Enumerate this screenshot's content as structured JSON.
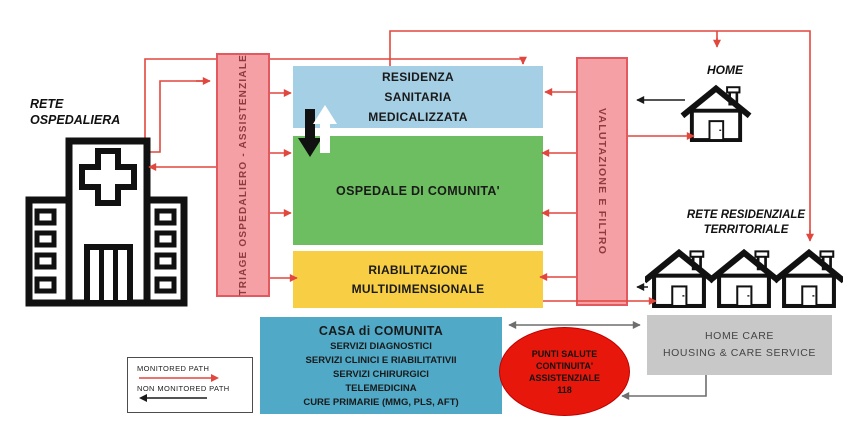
{
  "nodes": {
    "rete_ospedaliera": {
      "line1": "RETE",
      "line2": "OSPEDALIERA"
    },
    "triage": {
      "label": "TRIAGE OSPEDALIERO - ASSISTENZIALE"
    },
    "residenza": {
      "line1": "RESIDENZA",
      "line2": "SANITARIA",
      "line3": "MEDICALIZZATA"
    },
    "ospedale": {
      "label": "OSPEDALE DI COMUNITA'"
    },
    "riabilitazione": {
      "line1": "RIABILITAZIONE",
      "line2": "MULTIDIMENSIONALE"
    },
    "valutazione": {
      "label": "VALUTAZIONE E FILTRO"
    },
    "home": {
      "label": "HOME"
    },
    "rete_territoriale": {
      "line1": "RETE RESIDENZIALE",
      "line2": "TERRITORIALE"
    },
    "casa": {
      "title": "CASA di COMUNITA",
      "items": [
        "SERVIZI DIAGNOSTICI",
        "SERVIZI  CLINICI  E RIABILITATIVII",
        "SERVIZI CHIRURGICI",
        "TELEMEDICINA",
        "CURE PRIMARIE (MMG, PLS, AFT)"
      ]
    },
    "punti_salute": {
      "line1": "PUNTI SALUTE",
      "line2": "CONTINUITA'",
      "line3": "ASSISTENZIALE",
      "line4": "118"
    },
    "home_care": {
      "line1": "HOME CARE",
      "line2": "HOUSING  &  CARE SERVICE"
    }
  },
  "legend": {
    "monitored": "MONITORED PATH",
    "non_monitored": "NON MONITORED PATH"
  },
  "colors": {
    "monitored_path": "#E2473E",
    "non_monitored_path": "#1A1A1A",
    "gray_path": "#6E6E6E",
    "triage_fill": "#F4A0A4",
    "triage_border": "#E25A60",
    "triage_text": "#8E3B40",
    "residenza_fill": "#A4CFE4",
    "ospedale_fill": "#6CBE60",
    "riabilitazione_fill": "#F8CE45",
    "casa_fill": "#4FA9C7",
    "punti_salute_fill": "#E8170B",
    "home_care_fill": "#C8C8C8"
  }
}
